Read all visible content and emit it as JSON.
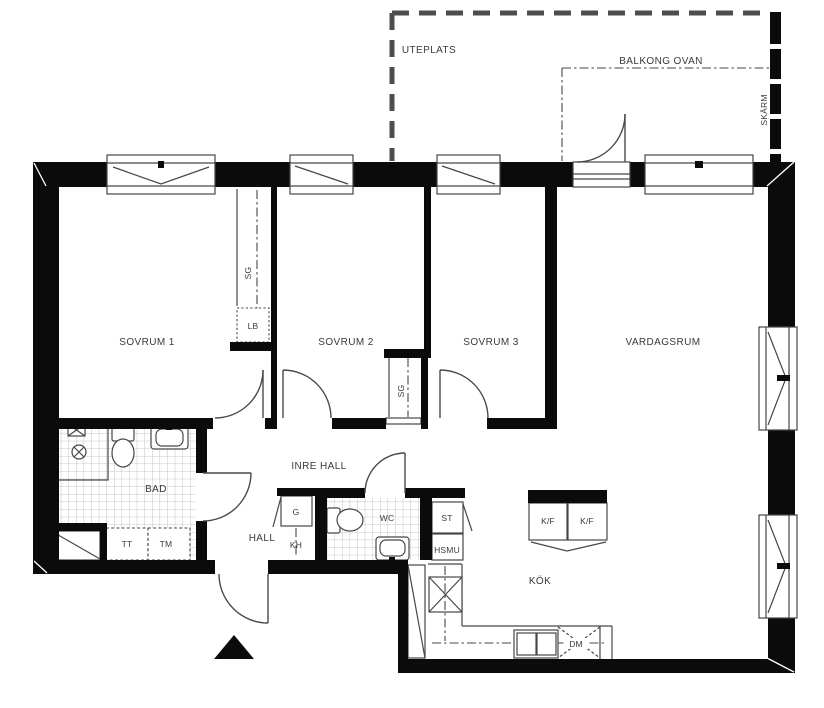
{
  "labels": {
    "uteplats": "UTEPLATS",
    "balkong_ovan": "BALKONG OVAN",
    "skarm": "SKÄRM",
    "sovrum1": "SOVRUM 1",
    "sovrum2": "SOVRUM 2",
    "sovrum3": "SOVRUM 3",
    "vardagsrum": "VARDAGSRUM",
    "inre_hall": "INRE HALL",
    "hall": "HALL",
    "bad": "BAD",
    "wc": "WC",
    "kok": "KÖK",
    "sg_closet_1": "SG",
    "sg_closet_2": "SG",
    "lb": "LB",
    "g": "G",
    "kh": "KH",
    "st": "ST",
    "hsmu": "HSMU",
    "kf_left": "K/F",
    "kf_right": "K/F",
    "dm": "DM",
    "tt": "TT",
    "tm": "TM"
  },
  "colors": {
    "wall": "#0b0b0b",
    "line": "#474747",
    "tile": "#b5b5b5",
    "text": "#3a3a3a",
    "background": "#ffffff"
  }
}
